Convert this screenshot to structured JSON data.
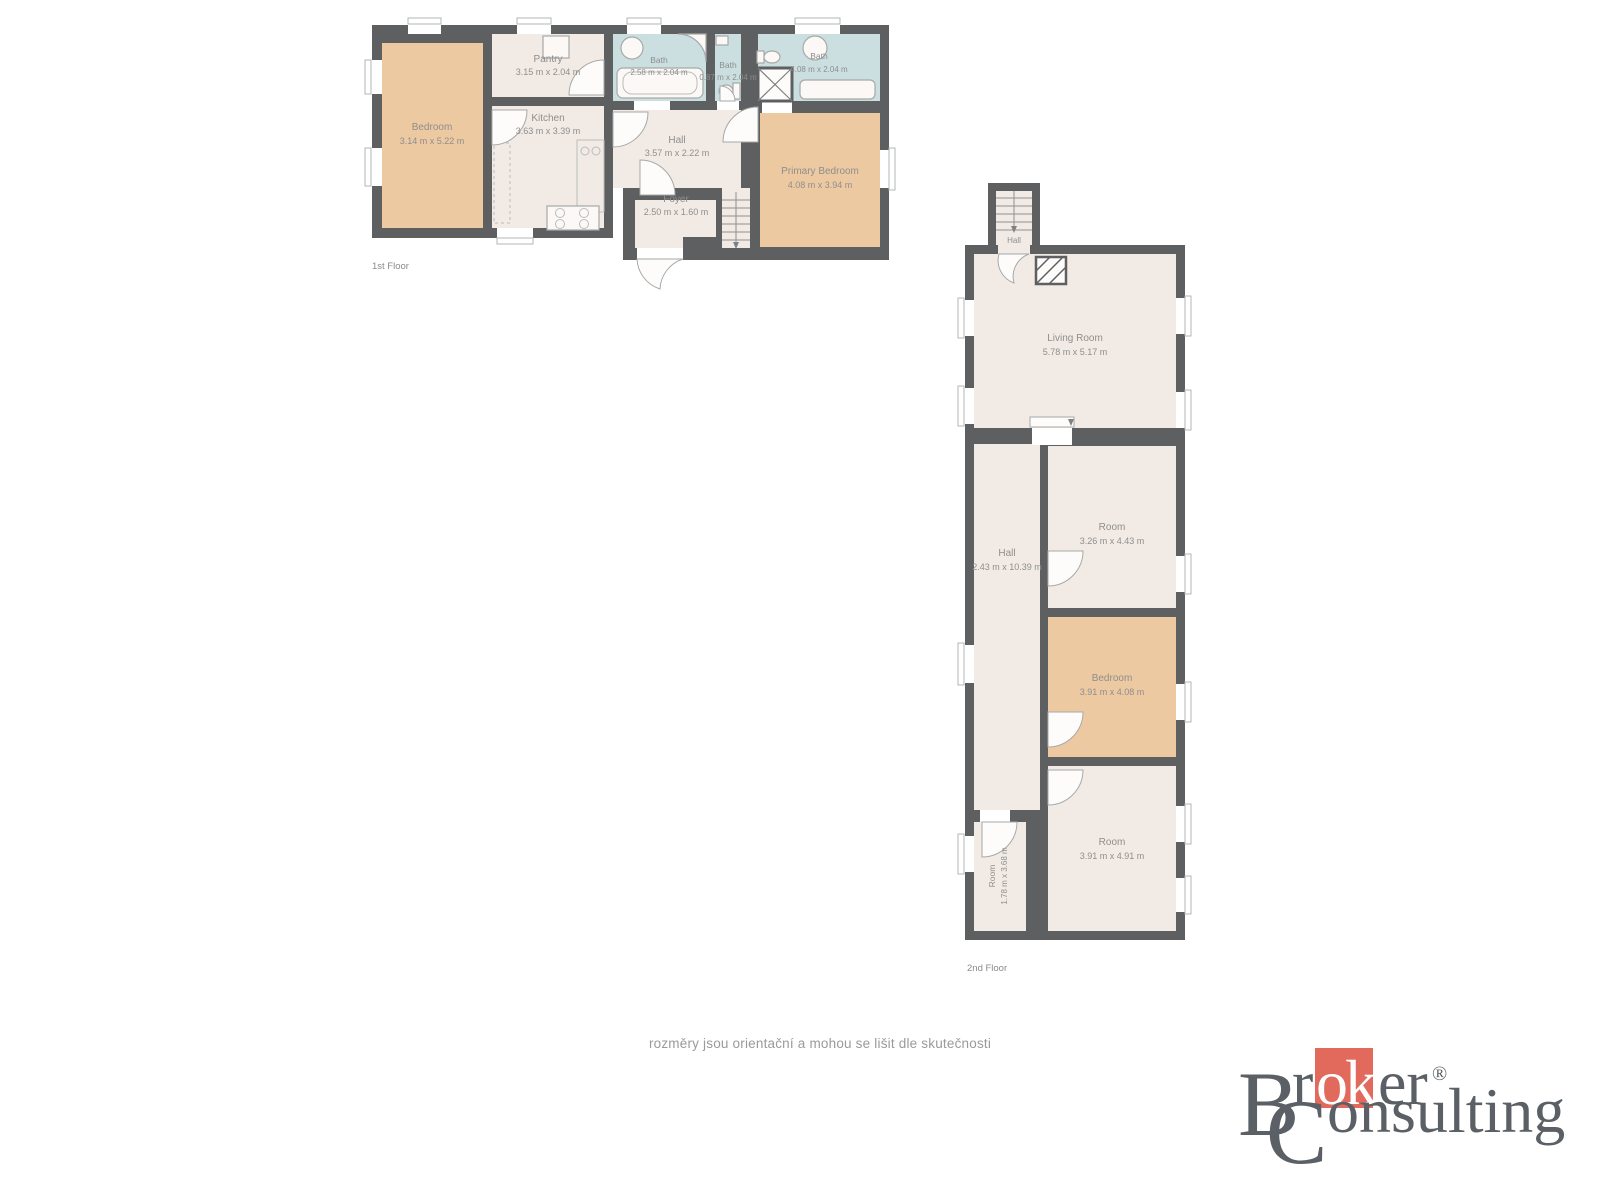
{
  "floor1": {
    "label": "1st Floor",
    "rooms": {
      "bedroom": {
        "name": "Bedroom",
        "dims": "3.14 m x 5.22 m"
      },
      "pantry": {
        "name": "Pantry",
        "dims": "3.15 m x 2.04 m"
      },
      "kitchen": {
        "name": "Kitchen",
        "dims": "3.63 m x 3.39 m"
      },
      "bath1": {
        "name": "Bath",
        "dims": "2.58 m x 2.04 m"
      },
      "bath2": {
        "name": "Bath",
        "dims": "0.87 m x 2.04 m"
      },
      "bath3": {
        "name": "Bath",
        "dims": "4.08 m x 2.04 m"
      },
      "hall": {
        "name": "Hall",
        "dims": "3.57 m x 2.22 m"
      },
      "foyer": {
        "name": "Foyer",
        "dims": "2.50 m x 1.60 m"
      },
      "primary_bedroom": {
        "name": "Primary Bedroom",
        "dims": "4.08 m x 3.94 m"
      }
    }
  },
  "floor2": {
    "label": "2nd Floor",
    "rooms": {
      "stair_hall": {
        "name": "Hall",
        "dims": "m x 0."
      },
      "living_room": {
        "name": "Living Room",
        "dims": "5.78 m x 5.17 m"
      },
      "hall": {
        "name": "Hall",
        "dims": "2.43 m x 10.39 m"
      },
      "room1": {
        "name": "Room",
        "dims": "3.26 m x 4.43 m"
      },
      "bedroom": {
        "name": "Bedroom",
        "dims": "3.91 m x 4.08 m"
      },
      "room2": {
        "name": "Room",
        "dims": "3.91 m x 4.91 m"
      },
      "room3": {
        "name": "Room",
        "dims": "1.78 m x 3.68 m"
      }
    }
  },
  "disclaimer": "rozměry jsou orientační a mohou se lišit dle skutečnosti",
  "logo": {
    "initial1": "B",
    "part1": "r",
    "highlight": "ok",
    "part2": "er",
    "registered": "®",
    "initial2": "C",
    "part3": "onsulting"
  },
  "colors": {
    "wall": "#5d5f60",
    "room_fill": "#f2ebe5",
    "accent_fill": "#edc9a2",
    "bath_fill": "#cbdfe1",
    "label_text": "#8e8e8e",
    "logo_text": "#5a6065",
    "logo_red": "#e16a5d"
  }
}
